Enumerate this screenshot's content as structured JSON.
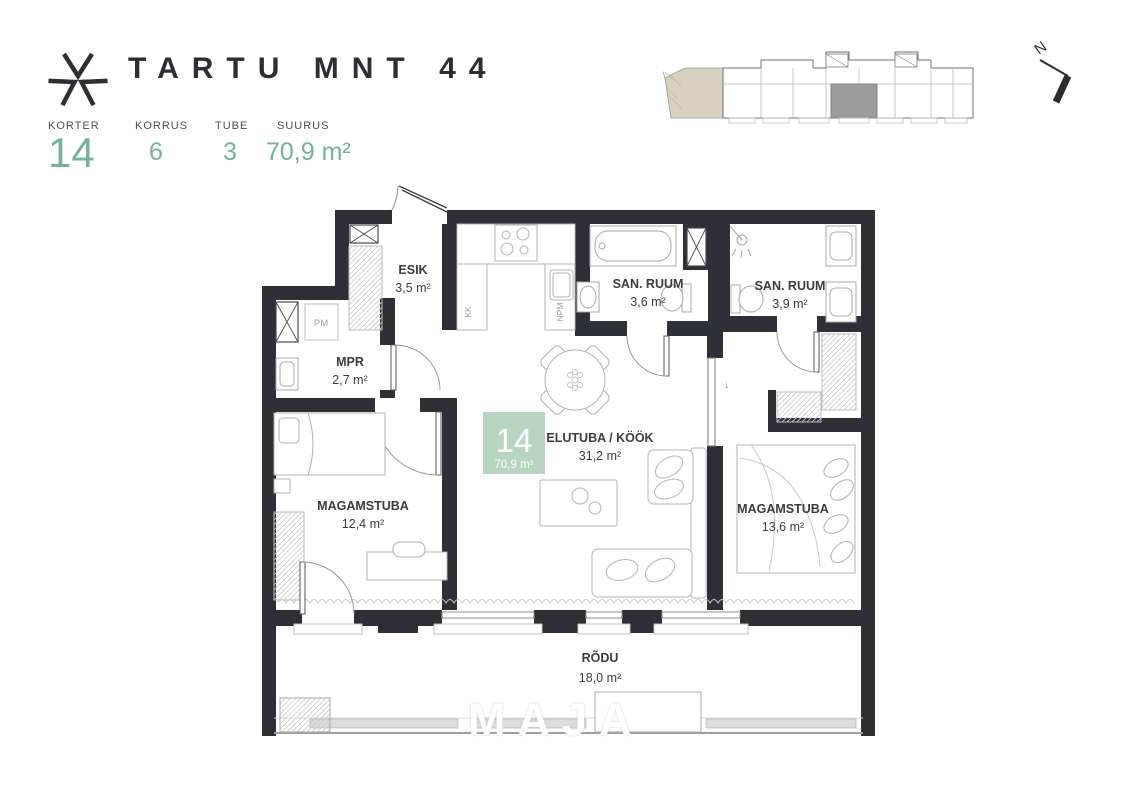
{
  "project": {
    "title": "TARTU MNT 44"
  },
  "stats": [
    {
      "label": "KORTER",
      "value": "14"
    },
    {
      "label": "KORRUS",
      "value": "6"
    },
    {
      "label": "TUBE",
      "value": "3"
    },
    {
      "label": "SUURUS",
      "value": "70,9 m²"
    }
  ],
  "compass": {
    "label": "N"
  },
  "unit_badge": {
    "number": "14",
    "area": "70,9 m²"
  },
  "rooms": {
    "esik": {
      "name": "ESIK",
      "area": "3,5 m²"
    },
    "mpr": {
      "name": "MPR",
      "area": "2,7 m²"
    },
    "san_ruum_1": {
      "name": "SAN. RUUM",
      "area": "3,6 m²"
    },
    "san_ruum_2": {
      "name": "SAN. RUUM",
      "area": "3,9 m²"
    },
    "elutuba": {
      "name": "ELUTUBA / KÖÖK",
      "area": "31,2 m²"
    },
    "magamistuba_1": {
      "name": "MAGAMSTUBA",
      "area": "12,4 m²"
    },
    "magamistuba_2": {
      "name": "MAGAMSTUBA",
      "area": "13,6 m²"
    },
    "rodu": {
      "name": "RÕDU",
      "area": "18,0 m²"
    }
  },
  "appliances": {
    "pm": "PM",
    "kk": "KK",
    "npm": "NPM"
  },
  "symbols": {
    "slide_arrow": "↓"
  },
  "watermark": "MAJA",
  "colors": {
    "accent": "#74b294",
    "badge": "#b8d5c4",
    "wall": "#2f2f37"
  }
}
